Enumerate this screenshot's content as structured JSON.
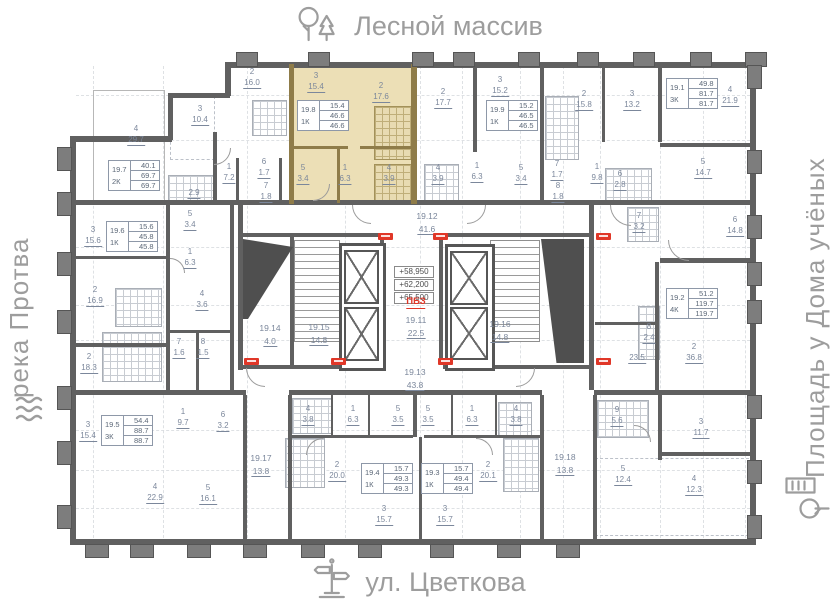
{
  "surroundings": {
    "top": "Лесной массив",
    "bottom": "ул. Цветкова",
    "left": "река Протва",
    "right": "Площадь у Дома учёных"
  },
  "core": {
    "elevations": [
      "+58,950",
      "+62,200",
      "+65,500"
    ],
    "zone_label": "ПБЗ",
    "badges": [
      [
        378,
        233
      ],
      [
        433,
        233
      ],
      [
        596,
        233
      ],
      [
        244,
        358
      ],
      [
        331,
        358
      ],
      [
        438,
        358
      ],
      [
        596,
        358
      ]
    ]
  },
  "colors": {
    "highlight": "#ecdfb6",
    "wall": "#606060",
    "accent_red": "#e03728",
    "label": "#7b879b"
  },
  "apartments": [
    {
      "id": "19.7",
      "type": "2К",
      "values": [
        "40.1",
        "69.7",
        "69.7"
      ],
      "x": 108,
      "y": 160
    },
    {
      "id": "19.8",
      "type": "1К",
      "values": [
        "15.4",
        "46.6",
        "46.6"
      ],
      "x": 297,
      "y": 100,
      "hl": true
    },
    {
      "id": "19.9",
      "type": "1К",
      "values": [
        "15.2",
        "46.5",
        "46.5"
      ],
      "x": 486,
      "y": 100
    },
    {
      "id": "19.1",
      "type": "3К",
      "values": [
        "49.8",
        "81.7",
        "81.7"
      ],
      "x": 666,
      "y": 78
    },
    {
      "id": "19.6",
      "type": "1К",
      "values": [
        "15.6",
        "45.8",
        "45.8"
      ],
      "x": 106,
      "y": 221
    },
    {
      "id": "19.5",
      "type": "3К",
      "values": [
        "54.4",
        "88.7",
        "88.7"
      ],
      "x": 101,
      "y": 415
    },
    {
      "id": "19.2",
      "type": "4К",
      "values": [
        "51.2",
        "119.7",
        "119.7"
      ],
      "x": 666,
      "y": 288
    },
    {
      "id": "19.4",
      "type": "1К",
      "values": [
        "15.7",
        "49.3",
        "49.3"
      ],
      "x": 361,
      "y": 463
    },
    {
      "id": "19.3",
      "type": "1К",
      "values": [
        "15.7",
        "49.4",
        "49.4"
      ],
      "x": 421,
      "y": 463
    }
  ],
  "corridors": [
    {
      "id": "19.12",
      "a": "41.6",
      "x": 427,
      "y": 212
    },
    {
      "id": "19.11",
      "a": "22.5",
      "x": 416,
      "y": 316
    },
    {
      "id": "19.13",
      "a": "43.8",
      "x": 415,
      "y": 368
    },
    {
      "id": "19.14",
      "a": "4.0",
      "x": 270,
      "y": 324
    },
    {
      "id": "19.15",
      "a": "14.8",
      "x": 319,
      "y": 323
    },
    {
      "id": "19.16",
      "a": "14.8",
      "x": 500,
      "y": 320
    },
    {
      "id": "19.17",
      "a": "13.8",
      "x": 261,
      "y": 454
    },
    {
      "id": "19.18",
      "a": "13.8",
      "x": 565,
      "y": 453
    }
  ],
  "rooms": [
    {
      "n": "2",
      "a": "16.0",
      "x": 252,
      "y": 68
    },
    {
      "n": "3",
      "a": "15.4",
      "x": 316,
      "y": 72,
      "hl": true
    },
    {
      "n": "2",
      "a": "17.6",
      "x": 381,
      "y": 82,
      "hl": true
    },
    {
      "n": "2",
      "a": "17.7",
      "x": 443,
      "y": 88
    },
    {
      "n": "3",
      "a": "15.2",
      "x": 500,
      "y": 76
    },
    {
      "n": "2",
      "a": "15.8",
      "x": 584,
      "y": 90
    },
    {
      "n": "3",
      "a": "13.2",
      "x": 632,
      "y": 90
    },
    {
      "n": "4",
      "a": "21.9",
      "x": 730,
      "y": 86
    },
    {
      "n": "3",
      "a": "10.4",
      "x": 200,
      "y": 105
    },
    {
      "n": "4",
      "a": "29.7",
      "x": 136,
      "y": 125
    },
    {
      "n": "1",
      "a": "7.2",
      "x": 229,
      "y": 163
    },
    {
      "n": "6",
      "a": "1.7",
      "x": 264,
      "y": 158
    },
    {
      "n": "7",
      "a": "1.8",
      "x": 266,
      "y": 182
    },
    {
      "n": "",
      "a": "2.9",
      "x": 194,
      "y": 186
    },
    {
      "n": "5",
      "a": "3.4",
      "x": 303,
      "y": 164,
      "hl": true
    },
    {
      "n": "1",
      "a": "6.3",
      "x": 345,
      "y": 164,
      "hl": true
    },
    {
      "n": "4",
      "a": "3.9",
      "x": 389,
      "y": 164,
      "hl": true
    },
    {
      "n": "4",
      "a": "3.9",
      "x": 438,
      "y": 164
    },
    {
      "n": "1",
      "a": "6.3",
      "x": 477,
      "y": 162
    },
    {
      "n": "5",
      "a": "3.4",
      "x": 521,
      "y": 164
    },
    {
      "n": "7",
      "a": "1.7",
      "x": 557,
      "y": 160
    },
    {
      "n": "8",
      "a": "1.8",
      "x": 558,
      "y": 182
    },
    {
      "n": "1",
      "a": "9.8",
      "x": 597,
      "y": 163
    },
    {
      "n": "6",
      "a": "2.8",
      "x": 620,
      "y": 170
    },
    {
      "n": "5",
      "a": "14.7",
      "x": 703,
      "y": 158
    },
    {
      "n": "6",
      "a": "14.8",
      "x": 735,
      "y": 216
    },
    {
      "n": "7",
      "a": "3.2",
      "x": 639,
      "y": 212
    },
    {
      "n": "3",
      "a": "15.6",
      "x": 93,
      "y": 226
    },
    {
      "n": "2",
      "a": "16.9",
      "x": 95,
      "y": 286
    },
    {
      "n": "5",
      "a": "3.4",
      "x": 190,
      "y": 210
    },
    {
      "n": "1",
      "a": "6.3",
      "x": 190,
      "y": 248
    },
    {
      "n": "4",
      "a": "3.6",
      "x": 202,
      "y": 290
    },
    {
      "n": "2",
      "a": "18.3",
      "x": 89,
      "y": 353
    },
    {
      "n": "7",
      "a": "1.6",
      "x": 179,
      "y": 338
    },
    {
      "n": "8",
      "a": "1.5",
      "x": 203,
      "y": 338
    },
    {
      "n": "8",
      "a": "2.4",
      "x": 649,
      "y": 323
    },
    {
      "n": "",
      "a": "23.5",
      "x": 637,
      "y": 351
    },
    {
      "n": "2",
      "a": "36.8",
      "x": 694,
      "y": 343
    },
    {
      "n": "3",
      "a": "15.4",
      "x": 88,
      "y": 421
    },
    {
      "n": "1",
      "a": "9.7",
      "x": 183,
      "y": 408
    },
    {
      "n": "6",
      "a": "3.2",
      "x": 223,
      "y": 411
    },
    {
      "n": "4",
      "a": "22.9",
      "x": 155,
      "y": 483
    },
    {
      "n": "5",
      "a": "16.1",
      "x": 208,
      "y": 484
    },
    {
      "n": "4",
      "a": "3.8",
      "x": 308,
      "y": 405
    },
    {
      "n": "1",
      "a": "6.3",
      "x": 353,
      "y": 405
    },
    {
      "n": "5",
      "a": "3.5",
      "x": 398,
      "y": 405
    },
    {
      "n": "5",
      "a": "3.5",
      "x": 428,
      "y": 405
    },
    {
      "n": "1",
      "a": "6.3",
      "x": 472,
      "y": 405
    },
    {
      "n": "4",
      "a": "3.8",
      "x": 516,
      "y": 405
    },
    {
      "n": "2",
      "a": "20.0",
      "x": 337,
      "y": 461
    },
    {
      "n": "2",
      "a": "20.1",
      "x": 488,
      "y": 461
    },
    {
      "n": "3",
      "a": "15.7",
      "x": 384,
      "y": 505
    },
    {
      "n": "3",
      "a": "15.7",
      "x": 445,
      "y": 505
    },
    {
      "n": "9",
      "a": "5.6",
      "x": 617,
      "y": 406
    },
    {
      "n": "3",
      "a": "11.7",
      "x": 701,
      "y": 418
    },
    {
      "n": "5",
      "a": "12.4",
      "x": 623,
      "y": 465
    },
    {
      "n": "4",
      "a": "12.3",
      "x": 694,
      "y": 475
    }
  ]
}
